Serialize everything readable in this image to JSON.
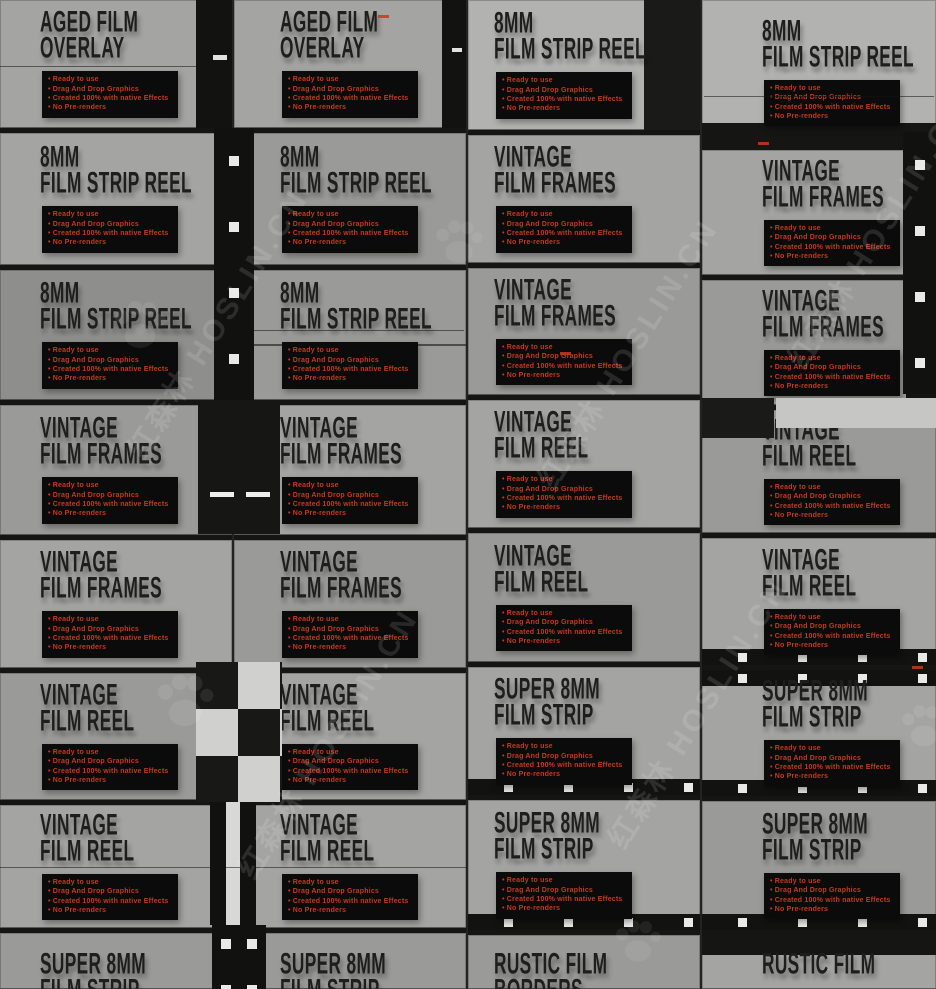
{
  "watermark": {
    "text_cn": "红森林",
    "text_en": "HOSLIN.CN"
  },
  "features": [
    "Ready to use",
    "Drag And Drop Graphics",
    "Created 100% with native Effects",
    "No Pre-renders"
  ],
  "colors": {
    "canvas_bg": "#232321",
    "tile_a": "#a4a4a2",
    "tile_b": "#9a9a98",
    "tile_c": "#b2b2b0",
    "tile_d": "#8e8e8c",
    "strip_black": "#151513",
    "title_black": "#1e1e1c",
    "feature_red": "#c43a1e",
    "feature_bg": "#0b0b0b",
    "sprocket_white": "#e9e9e7"
  },
  "columns": [
    {
      "tiles": [
        {
          "line1": "AGED FILM",
          "line2": "OVERLAY",
          "h": 128,
          "shade": "a",
          "decor": "edge-right"
        },
        {
          "line1": "8MM",
          "line2": "FILM STRIP REEL",
          "h": 137,
          "shade": "a",
          "decor": ""
        },
        {
          "line1": "8MM",
          "line2": "FILM STRIP REEL",
          "h": 135,
          "shade": "d",
          "decor": ""
        },
        {
          "line1": "VINTAGE",
          "line2": "FILM FRAMES",
          "h": 135,
          "shade": "b",
          "decor": ""
        },
        {
          "line1": "VINTAGE",
          "line2": "FILM FRAMES",
          "h": 133,
          "shade": "a",
          "decor": ""
        },
        {
          "line1": "VINTAGE",
          "line2": "FILM REEL",
          "h": 132,
          "shade": "b",
          "decor": ""
        },
        {
          "line1": "VINTAGE",
          "line2": "FILM REEL",
          "h": 128,
          "shade": "a",
          "decor": ""
        },
        {
          "line1": "SUPER 8MM",
          "line2": "FILM STRIP",
          "h": 61,
          "shade": "b",
          "decor": ""
        }
      ]
    },
    {
      "tiles": [
        {
          "line1": "AGED FILM",
          "line2": "OVERLAY",
          "h": 128,
          "shade": "a",
          "decor": "edge-right-thin"
        },
        {
          "line1": "8MM",
          "line2": "FILM STRIP REEL",
          "h": 137,
          "shade": "b",
          "decor": ""
        },
        {
          "line1": "8MM",
          "line2": "FILM STRIP REEL",
          "h": 135,
          "shade": "b",
          "decor": "strike-line"
        },
        {
          "line1": "VINTAGE",
          "line2": "FILM FRAMES",
          "h": 135,
          "shade": "a",
          "decor": ""
        },
        {
          "line1": "VINTAGE",
          "line2": "FILM FRAMES",
          "h": 133,
          "shade": "b",
          "decor": ""
        },
        {
          "line1": "VINTAGE",
          "line2": "FILM REEL",
          "h": 132,
          "shade": "a",
          "decor": ""
        },
        {
          "line1": "VINTAGE",
          "line2": "FILM REEL",
          "h": 128,
          "shade": "a",
          "decor": ""
        },
        {
          "line1": "SUPER 8MM",
          "line2": "FILM STRIP",
          "h": 61,
          "shade": "b",
          "decor": ""
        }
      ]
    },
    {
      "tiles": [
        {
          "line1": "8MM",
          "line2": "FILM STRIP REEL",
          "h": 130,
          "shade": "c",
          "decor": "dark-right-block"
        },
        {
          "line1": "VINTAGE",
          "line2": "FILM FRAMES",
          "h": 133,
          "shade": "a",
          "decor": ""
        },
        {
          "line1": "VINTAGE",
          "line2": "FILM FRAMES",
          "h": 132,
          "shade": "b",
          "decor": ""
        },
        {
          "line1": "VINTAGE",
          "line2": "FILM REEL",
          "h": 133,
          "shade": "a",
          "decor": ""
        },
        {
          "line1": "VINTAGE",
          "line2": "FILM REEL",
          "h": 134,
          "shade": "b",
          "decor": ""
        },
        {
          "line1": "SUPER 8MM",
          "line2": "FILM STRIP",
          "h": 133,
          "shade": "a",
          "decor": "sprocket-bottom"
        },
        {
          "line1": "SUPER 8MM",
          "line2": "FILM STRIP",
          "h": 135,
          "shade": "a",
          "decor": "sprocket-bottom"
        },
        {
          "line1": "RUSTIC FILM",
          "line2": "BORDERS",
          "h": 59,
          "shade": "b",
          "decor": ""
        }
      ]
    },
    {
      "tiles": [
        {
          "line1": "8MM",
          "line2": "FILM STRIP REEL",
          "h": 145,
          "shade": "c",
          "decor": "dark-bottom-tall"
        },
        {
          "line1": "VINTAGE",
          "line2": "FILM FRAMES",
          "h": 130,
          "shade": "a",
          "decor": "sprocket-right"
        },
        {
          "line1": "VINTAGE",
          "line2": "FILM FRAMES",
          "h": 130,
          "shade": "b",
          "decor": "sprocket-right"
        },
        {
          "line1": "VINTAGE",
          "line2": "FILM REEL",
          "h": 128,
          "shade": "b",
          "decor": ""
        },
        {
          "line1": "VINTAGE",
          "line2": "FILM REEL",
          "h": 132,
          "shade": "a",
          "decor": "sprocket-bottom"
        },
        {
          "line1": "SUPER 8MM",
          "line2": "FILM STRIP",
          "h": 131,
          "shade": "a",
          "decor": "sprocket-top sprocket-bottom"
        },
        {
          "line1": "SUPER 8MM",
          "line2": "FILM STRIP",
          "h": 134,
          "shade": "b",
          "decor": "sprocket-bottom"
        },
        {
          "line1": "RUSTIC FILM",
          "line2": "",
          "h": 59,
          "shade": "a",
          "decor": "dark-top"
        }
      ]
    }
  ]
}
